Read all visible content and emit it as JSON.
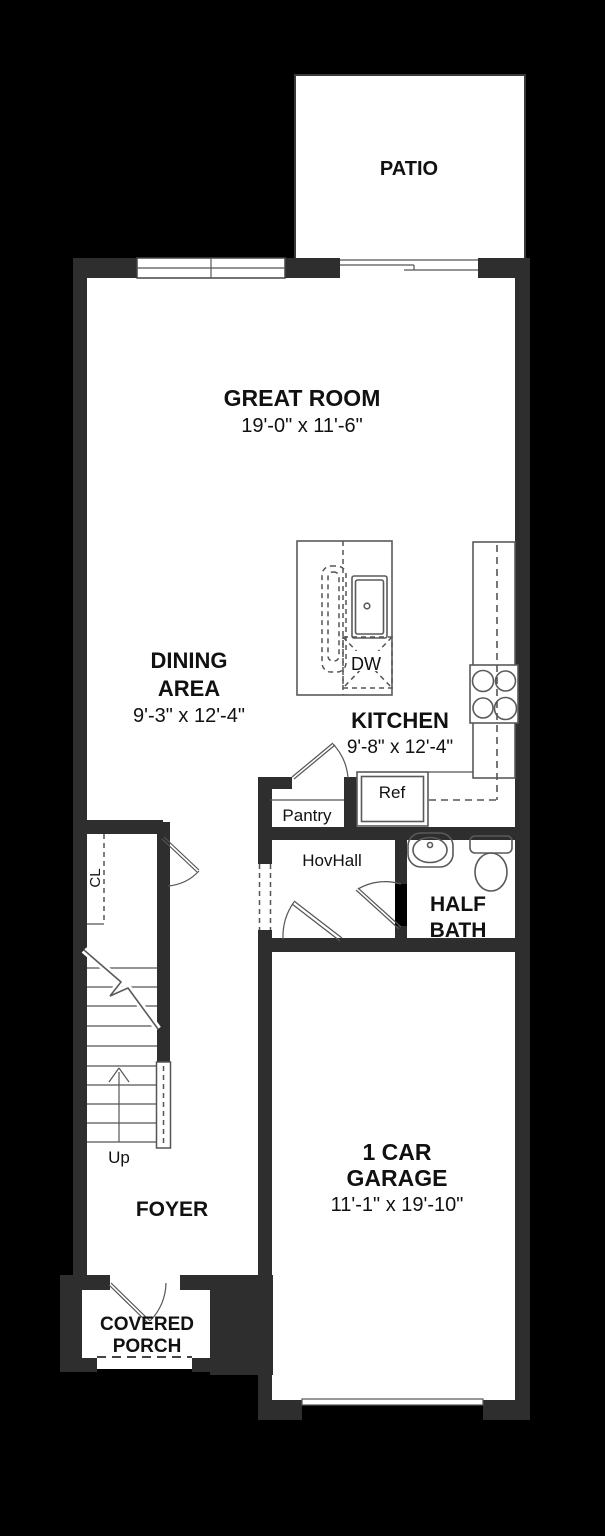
{
  "plan": {
    "title": "Townhome first floor plan",
    "colors": {
      "background": "#000000",
      "wall": "#2e2e2e",
      "floor": "#ffffff",
      "line": "#555555",
      "text": "#111111"
    },
    "rooms": {
      "patio": {
        "label": "PATIO"
      },
      "great_room": {
        "label": "GREAT ROOM",
        "dims": "19'-0\" x 11'-6\""
      },
      "dining": {
        "line1": "DINING",
        "line2": "AREA",
        "dims": "9'-3\" x 12'-4\""
      },
      "kitchen": {
        "label": "KITCHEN",
        "dims": "9'-8\" x 12'-4\""
      },
      "pantry": {
        "label": "Pantry"
      },
      "fridge": {
        "label": "Ref"
      },
      "dishwasher": {
        "label": "DW"
      },
      "hall": {
        "label": "HovHall"
      },
      "half_bath": {
        "line1": "HALF",
        "line2": "BATH"
      },
      "closet": {
        "label": "CL"
      },
      "stairs": {
        "label": "Up"
      },
      "foyer": {
        "label": "FOYER"
      },
      "porch": {
        "line1": "COVERED",
        "line2": "PORCH"
      },
      "garage": {
        "line1": "1 CAR",
        "line2": "GARAGE",
        "dims": "11'-1\" x 19'-10\""
      }
    }
  }
}
